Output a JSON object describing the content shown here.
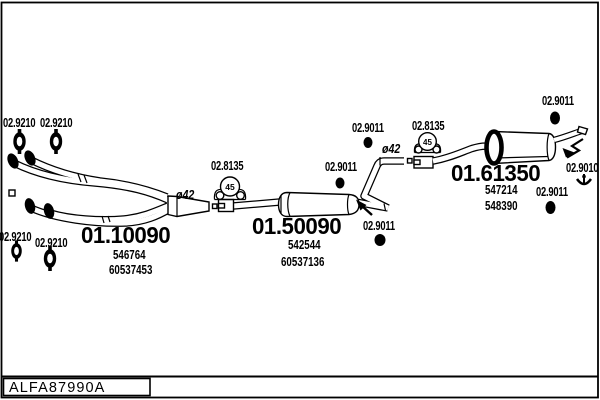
{
  "title_block": {
    "drawing_code": "ALFA87990A"
  },
  "parts": {
    "front_pipe": {
      "number": "01.10090",
      "refs": [
        "546764",
        "60537453"
      ]
    },
    "center_silencer": {
      "number": "01.50090",
      "refs": [
        "542544",
        "60537136"
      ]
    },
    "rear_silencer": {
      "number": "01.61350",
      "refs": [
        "547214",
        "548390"
      ]
    }
  },
  "codes": {
    "gasket": "02.9210",
    "clamp": "02.8135",
    "mount": "02.9011",
    "hook": "02.9010",
    "diameter": "ø42",
    "clamp_size": "45"
  }
}
